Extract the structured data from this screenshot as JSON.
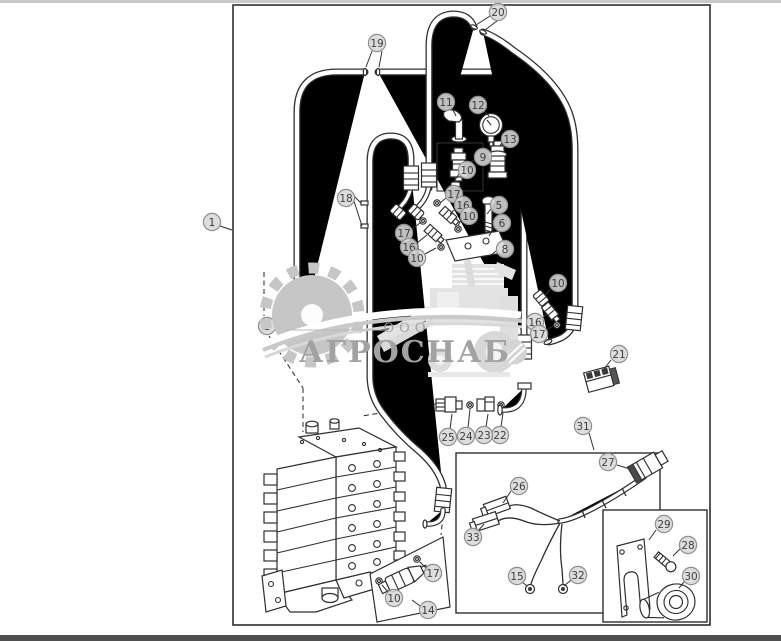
{
  "watermark": {
    "org_form": "ООО",
    "org_name": "АГРОСНАБ"
  },
  "colors": {
    "line": "#2f2f2f",
    "bubble_fill": "#d8d8d8",
    "bubble_stroke": "#8f8f8f",
    "bubble_text": "#3e3e3e",
    "watermark_grey": "#c6c6c6",
    "watermark_light": "#e3e3e3",
    "watermark_text": "#a2a2a2",
    "page_top_strip": "#c9c9c9",
    "page_bottom_strip": "#4f4f4f"
  },
  "callouts": [
    {
      "n": "1",
      "x": 212,
      "y": 222,
      "leaders": [
        [
          220,
          226,
          232,
          230
        ]
      ]
    },
    {
      "n": "2",
      "x": 267,
      "y": 326,
      "leaders": [],
      "layer": "under"
    },
    {
      "n": "5",
      "x": 499,
      "y": 205,
      "leaders": [
        [
          491,
          209,
          487,
          214
        ]
      ]
    },
    {
      "n": "6",
      "x": 502,
      "y": 223,
      "leaders": [
        [
          494,
          227,
          489,
          236
        ]
      ]
    },
    {
      "n": "8",
      "x": 505,
      "y": 249,
      "leaders": [
        [
          496,
          251,
          491,
          255
        ]
      ]
    },
    {
      "n": "9",
      "x": 483,
      "y": 157,
      "leaders": [
        [
          474,
          160,
          467,
          166
        ]
      ]
    },
    {
      "n": "10",
      "x": 467,
      "y": 170,
      "leaders": [
        [
          459,
          174,
          455,
          180
        ]
      ]
    },
    {
      "n": "11",
      "x": 446,
      "y": 102,
      "leaders": [
        [
          452,
          108,
          456,
          116
        ]
      ]
    },
    {
      "n": "12",
      "x": 478,
      "y": 105,
      "leaders": [
        [
          484,
          111,
          489,
          116
        ]
      ]
    },
    {
      "n": "13",
      "x": 510,
      "y": 139,
      "leaders": [
        [
          502,
          142,
          500,
          146
        ]
      ]
    },
    {
      "n": "17",
      "x": 454,
      "y": 194,
      "leaders": [
        [
          446,
          198,
          440,
          203
        ]
      ]
    },
    {
      "n": "16",
      "x": 463,
      "y": 205,
      "leaders": [
        [
          455,
          209,
          450,
          214
        ]
      ]
    },
    {
      "n": "10",
      "x": 469,
      "y": 216,
      "leaders": [
        [
          461,
          220,
          458,
          226
        ]
      ]
    },
    {
      "n": "17",
      "x": 404,
      "y": 233,
      "leaders": [
        [
          412,
          229,
          420,
          223
        ]
      ]
    },
    {
      "n": "16",
      "x": 409,
      "y": 247,
      "leaders": [
        [
          417,
          243,
          427,
          235
        ]
      ]
    },
    {
      "n": "10",
      "x": 417,
      "y": 258,
      "leaders": [
        [
          425,
          254,
          436,
          248
        ]
      ]
    },
    {
      "n": "18",
      "x": 346,
      "y": 198,
      "leaders": [
        [
          354,
          196,
          361,
          203
        ],
        [
          354,
          201,
          362,
          226
        ]
      ]
    },
    {
      "n": "19",
      "x": 377,
      "y": 43,
      "leaders": [
        [
          372,
          51,
          366,
          67
        ],
        [
          382,
          51,
          379,
          67
        ]
      ]
    },
    {
      "n": "20",
      "x": 498,
      "y": 12,
      "leaders": [
        [
          490,
          16,
          476,
          25
        ],
        [
          497,
          21,
          485,
          30
        ]
      ]
    },
    {
      "n": "21",
      "x": 619,
      "y": 354,
      "leaders": [
        [
          611,
          360,
          604,
          369
        ]
      ]
    },
    {
      "n": "22",
      "x": 500,
      "y": 435,
      "leaders": [
        [
          501,
          427,
          503,
          413
        ]
      ]
    },
    {
      "n": "23",
      "x": 484,
      "y": 435,
      "leaders": [
        [
          486,
          427,
          488,
          414
        ]
      ]
    },
    {
      "n": "24",
      "x": 466,
      "y": 436,
      "leaders": [
        [
          468,
          428,
          470,
          409
        ]
      ]
    },
    {
      "n": "25",
      "x": 448,
      "y": 437,
      "leaders": [
        [
          450,
          429,
          452,
          414
        ]
      ]
    },
    {
      "n": "26",
      "x": 519,
      "y": 486,
      "leaders": [
        [
          511,
          491,
          503,
          503
        ]
      ]
    },
    {
      "n": "27",
      "x": 608,
      "y": 462,
      "leaders": [
        [
          617,
          465,
          630,
          469
        ]
      ]
    },
    {
      "n": "28",
      "x": 688,
      "y": 545,
      "leaders": [
        [
          680,
          549,
          673,
          556
        ]
      ]
    },
    {
      "n": "29",
      "x": 664,
      "y": 524,
      "leaders": [
        [
          656,
          530,
          649,
          540
        ]
      ]
    },
    {
      "n": "30",
      "x": 691,
      "y": 576,
      "leaders": [
        [
          684,
          582,
          679,
          588
        ]
      ]
    },
    {
      "n": "31",
      "x": 583,
      "y": 426,
      "leaders": [
        [
          589,
          433,
          594,
          450
        ]
      ]
    },
    {
      "n": "32",
      "x": 578,
      "y": 575,
      "leaders": [
        [
          571,
          580,
          564,
          586
        ]
      ]
    },
    {
      "n": "33",
      "x": 473,
      "y": 537,
      "leaders": [
        [
          478,
          531,
          484,
          524
        ]
      ]
    },
    {
      "n": "14",
      "x": 428,
      "y": 610,
      "leaders": [
        [
          420,
          606,
          412,
          600
        ]
      ]
    },
    {
      "n": "17",
      "x": 433,
      "y": 573,
      "leaders": [
        [
          426,
          568,
          420,
          562
        ]
      ]
    },
    {
      "n": "10",
      "x": 394,
      "y": 598,
      "leaders": [
        [
          388,
          592,
          382,
          585
        ]
      ]
    },
    {
      "n": "15",
      "x": 517,
      "y": 576,
      "leaders": [
        [
          521,
          581,
          527,
          586
        ]
      ]
    },
    {
      "n": "16",
      "x": 535,
      "y": 322,
      "leaders": [
        [
          542,
          319,
          547,
          313
        ]
      ]
    },
    {
      "n": "17",
      "x": 539,
      "y": 334,
      "leaders": [
        [
          546,
          330,
          553,
          326
        ]
      ]
    },
    {
      "n": "10",
      "x": 558,
      "y": 283,
      "leaders": [
        [
          551,
          289,
          545,
          295
        ]
      ]
    }
  ]
}
